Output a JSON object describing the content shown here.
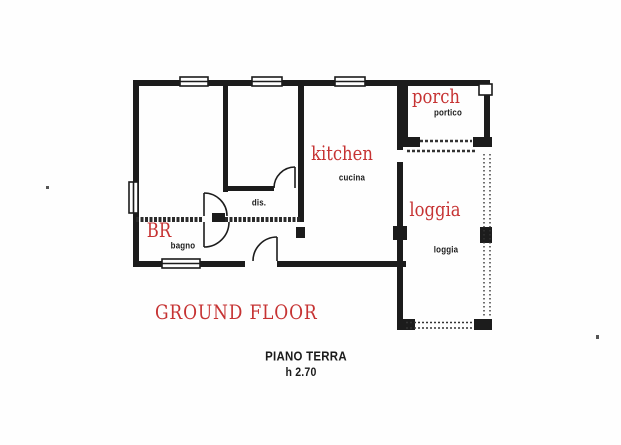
{
  "colors": {
    "label_red": "#c63333",
    "line_black": "#1c1c1c"
  },
  "rooms": {
    "porch": {
      "en": "porch",
      "it": "portico"
    },
    "kitchen": {
      "en": "kitchen",
      "it": "cucina"
    },
    "loggia": {
      "en": "loggia",
      "it": "loggia"
    },
    "bathroom": {
      "en": "BR",
      "it": "bagno"
    },
    "hall": {
      "it": "dis."
    }
  },
  "captions": {
    "floor_en": "GROUND FLOOR",
    "floor_it": "PIANO TERRA",
    "ceiling_height": "h 2.70"
  }
}
